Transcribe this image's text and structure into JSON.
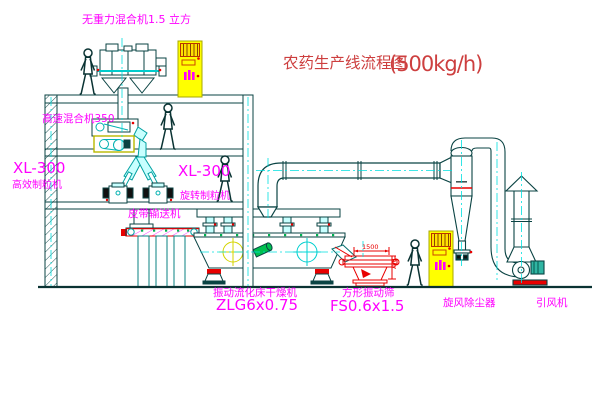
{
  "title": {
    "text_cn": "农药生产线流程图",
    "capacity": "(500kg/h)"
  },
  "labels": {
    "gravity_mixer": "无重力混合机1.5 立方",
    "high_speed_mixer": "高速混合机350",
    "granulator_left_model": "XL-300",
    "granulator_left_name": "高效制粒机",
    "granulator_right_model": "XL-300",
    "granulator_right_name": "旋转制粒机",
    "belt_conveyor": "皮带输送机",
    "dryer_name": "振动流化床干燥机",
    "dryer_model": "ZLG6x0.75",
    "screen_name": "方形振动筛",
    "screen_model": "FS0.6x1.5",
    "cyclone": "旋风除尘器",
    "fan": "引风机"
  },
  "dimensions": {
    "screen_length": "1500",
    "screen_height": "750"
  },
  "colors": {
    "drawing_line": "#0a4343",
    "centerline_cyan": "#00e0e0",
    "label_magenta": "#ff00ff",
    "annotation_red": "#e80000",
    "title_red": "#cd3f3f",
    "cabinet_yellow": "#ffff00",
    "clamp_green": "#00b050"
  }
}
